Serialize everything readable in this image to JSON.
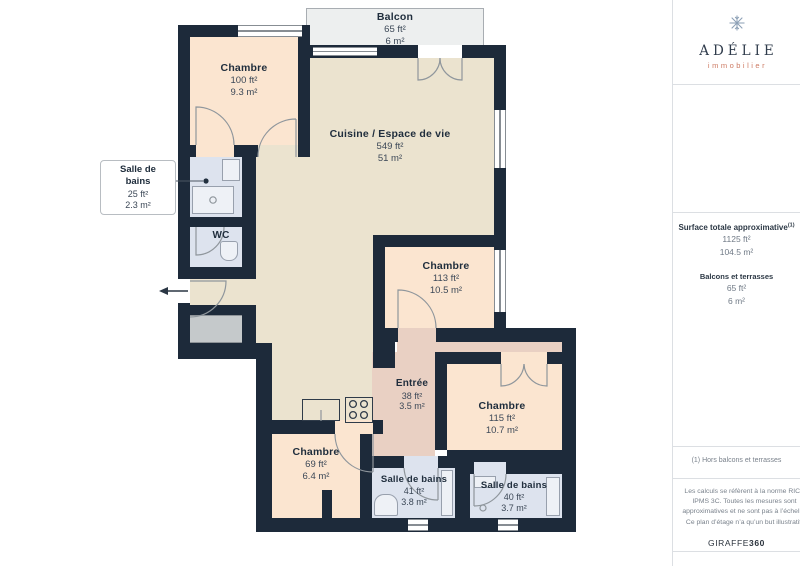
{
  "colors": {
    "wall": "#1d2a3a",
    "bedroom": "#fbe5d0",
    "living": "#ebe3cf",
    "bathroom": "#dde3ee",
    "entry": "#e9d0c3",
    "balcony": "#edefef",
    "storage": "#c5c9cb",
    "brand_navy": "#303c4c",
    "brand_coral": "#cd7b64"
  },
  "plan": {
    "balcony": {
      "name": "Balcon",
      "ft": "65 ft²",
      "m": "6 m²"
    },
    "rooms": [
      {
        "name": "Chambre",
        "ft": "100 ft²",
        "m": "9.3 m²"
      },
      {
        "name": "Salle de bains",
        "ft": "25 ft²",
        "m": "2.3 m²"
      },
      {
        "name": "WC",
        "ft": "",
        "m": ""
      },
      {
        "name": "Cuisine / Espace de vie",
        "ft": "549 ft²",
        "m": "51 m²"
      },
      {
        "name": "Chambre",
        "ft": "113 ft²",
        "m": "10.5 m²"
      },
      {
        "name": "Entrée",
        "ft": "38 ft²",
        "m": "3.5 m²"
      },
      {
        "name": "Chambre",
        "ft": "115 ft²",
        "m": "10.7 m²"
      },
      {
        "name": "Chambre",
        "ft": "69 ft²",
        "m": "6.4 m²"
      },
      {
        "name": "Salle de bains",
        "ft": "41 ft²",
        "m": "3.8 m²"
      },
      {
        "name": "Salle de bains",
        "ft": "40 ft²",
        "m": "3.7 m²"
      }
    ],
    "icons": {
      "entry_arrow": "left-arrow",
      "leader_dot": "dot"
    }
  },
  "sidebar": {
    "brand": {
      "name": "ADÉLIE",
      "tagline": "immobilier",
      "icon": "snowflake-icon"
    },
    "surface": {
      "title": "Surface totale approximative",
      "title_sup": "(1)",
      "total_ft": "1125 ft²",
      "total_m": "104.5 m²",
      "balconies_title": "Balcons et terrasses",
      "balconies_ft": "65 ft²",
      "balconies_m": "6 m²"
    },
    "footnote": "(1) Hors balcons et terrasses",
    "disclaimer": "Les calculs se réfèrent à la norme RICS IPMS 3C. Toutes les mesures sont approximatives et ne sont pas à l’échelle. Ce plan d’étage n’a qu’un but illustratif.",
    "credit": {
      "brand": "GIRAFFE",
      "suffix": "360"
    }
  }
}
